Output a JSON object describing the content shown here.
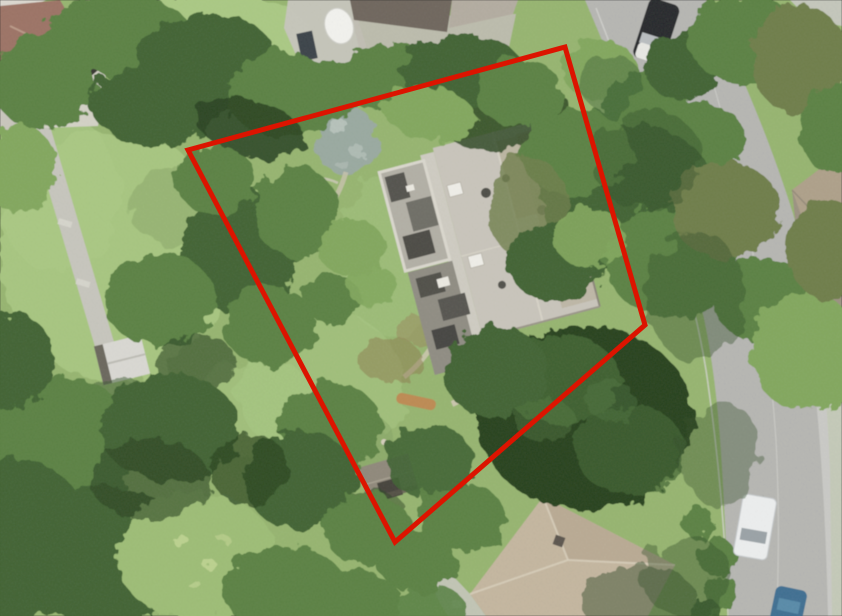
{
  "palette": {
    "lawn-mid": "#96b56f",
    "lawn-light": "#aac983",
    "lawn-shade": "#7e9e5f",
    "canopy-light": "#82a75d",
    "canopy-mid": "#5a8142",
    "canopy-dark": "#3f6230",
    "canopy-shadow": "#26411f",
    "canopy-olive": "#6e7d4a",
    "canopy-yellow": "#9dbd74",
    "road": "#b6b6b2",
    "path": "#c7c6bd",
    "roof-main": "#c9c5bb",
    "roof-brown": "#9c7264",
    "roof-flat": "#6e655c",
    "roof-tan": "#c4b69f",
    "roof-east": "#9b9181",
    "shed": "#8f887a",
    "pond": "#99a9a0",
    "umbrella": "#f4f4ef",
    "car-dark": "#26282a",
    "van-white": "#edefef",
    "car-blue": "#3e6e91",
    "boundary-red": "#dc1400"
  },
  "overlay": {
    "parcel_boundary": {
      "shape": "polygon",
      "points": "188,150 565,47 645,325 395,542",
      "vertices": [
        [
          188,
          150
        ],
        [
          565,
          47
        ],
        [
          645,
          325
        ],
        [
          395,
          542
        ]
      ],
      "color": "#dc1400",
      "stroke_width": 5
    }
  },
  "scene": {
    "type": "aerial-orthophoto",
    "size": {
      "width": 842,
      "height": 616
    },
    "features": [
      {
        "name": "main-house",
        "bbox": [
          375,
          115,
          225,
          230
        ]
      },
      {
        "name": "rooftop-terrace",
        "bbox": [
          375,
          160,
          75,
          185
        ]
      },
      {
        "name": "garden-pond",
        "bbox": [
          314,
          105,
          64,
          70
        ]
      },
      {
        "name": "patio-with-parasol",
        "bbox": [
          284,
          0,
          96,
          80
        ]
      },
      {
        "name": "neighbor-house-northwest",
        "bbox": [
          0,
          0,
          110,
          130
        ]
      },
      {
        "name": "neighbor-house-south",
        "bbox": [
          440,
          495,
          240,
          121
        ]
      },
      {
        "name": "neighbor-house-east",
        "bbox": [
          790,
          150,
          52,
          168
        ]
      },
      {
        "name": "garden-shed",
        "bbox": [
          358,
          455,
          60,
          50
        ]
      },
      {
        "name": "garden-pavilion-west",
        "bbox": [
          96,
          336,
          52,
          48
        ]
      },
      {
        "name": "footpath-west",
        "bbox": [
          28,
          124,
          90,
          230
        ]
      },
      {
        "name": "road-east",
        "bbox": [
          585,
          0,
          257,
          616
        ]
      },
      {
        "name": "car-dark",
        "bbox": [
          636,
          0,
          38,
          64
        ]
      },
      {
        "name": "van-white",
        "bbox": [
          736,
          494,
          38,
          66
        ]
      },
      {
        "name": "car-blue",
        "bbox": [
          772,
          588,
          34,
          28
        ]
      },
      {
        "name": "car-white",
        "bbox": [
          804,
          126,
          40,
          30
        ]
      }
    ]
  }
}
